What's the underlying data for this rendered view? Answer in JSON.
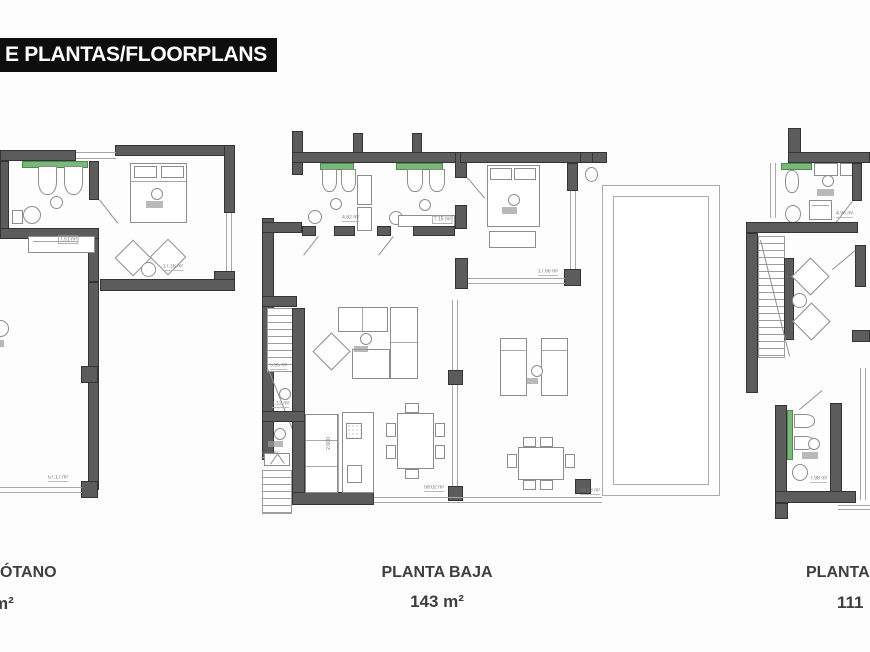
{
  "header": {
    "title": "E PLANTAS/FLOORPLANS"
  },
  "floorplans": [
    {
      "id": "sotano",
      "name": "ÓTANO",
      "area": "m²",
      "room_areas": {
        "bathroom": "7.51 m²",
        "bedroom": "17.16 m²",
        "garage": "57.17 m²"
      }
    },
    {
      "id": "planta-baja",
      "name": "PLANTA BAJA",
      "area": "143 m²",
      "room_areas": {
        "bathroom_1": "4.82 m²",
        "bathroom_2": "7.15 m²",
        "bedroom": "17.66 m²",
        "stairs": "5.95 m²",
        "hall": "1.12 m²",
        "closet": "1.71 m²",
        "living_kitchen": "58.02 m²",
        "terrace": "44.53 m²"
      },
      "kitchen_dimension": "2.600"
    },
    {
      "id": "planta-primera",
      "name": "PLANTA",
      "area": "111",
      "room_areas": {
        "bathroom_1": "4.96 m²",
        "bathroom_2": "7.98 m²"
      }
    }
  ]
}
